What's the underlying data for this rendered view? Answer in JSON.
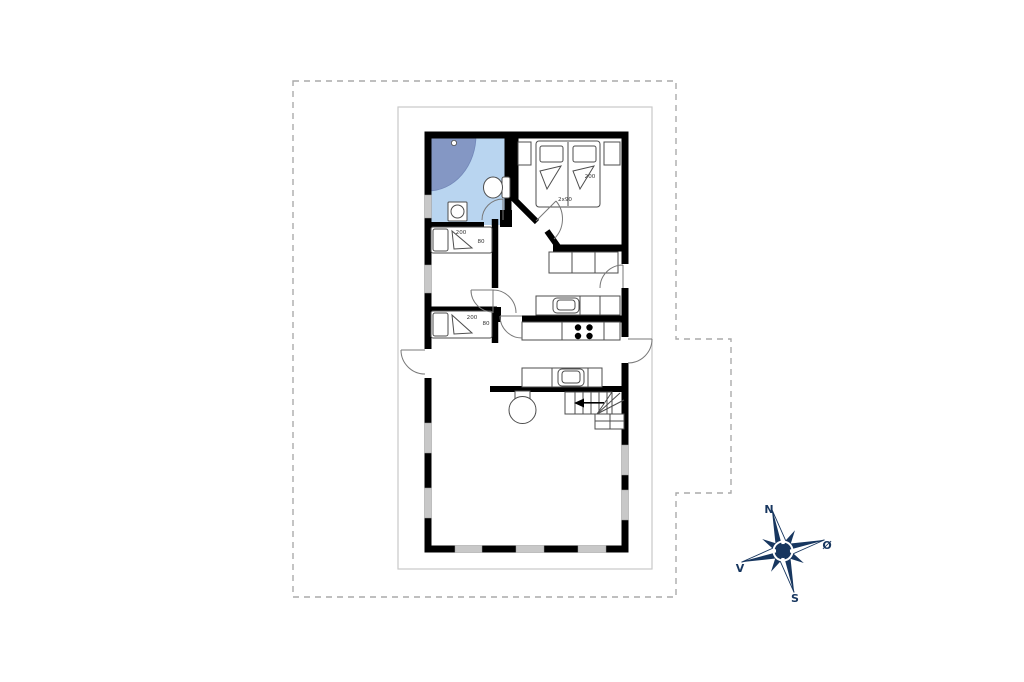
{
  "colors": {
    "wall": "#000000",
    "window": "#c8c8c8",
    "bath_floor": "#b9d5f0",
    "shower": "#8497c4",
    "compass": "#17365f",
    "boundary": "#aaaaaa",
    "frame": "#c9c9c9",
    "fixture": "#4d4d4d",
    "door": "#787878",
    "label_text": "#333333"
  },
  "floorplan": {
    "double_bedroom": {
      "bed_length_label": "200",
      "bed_size_label": "2x90"
    },
    "single_bedroom_1": {
      "bed_length_label": "200",
      "bed_width_label": "80"
    },
    "single_bedroom_2": {
      "bed_length_label": "200",
      "bed_width_label": "80"
    }
  },
  "compass": {
    "north": "N",
    "east": "Ø",
    "south": "S",
    "west": "V"
  }
}
